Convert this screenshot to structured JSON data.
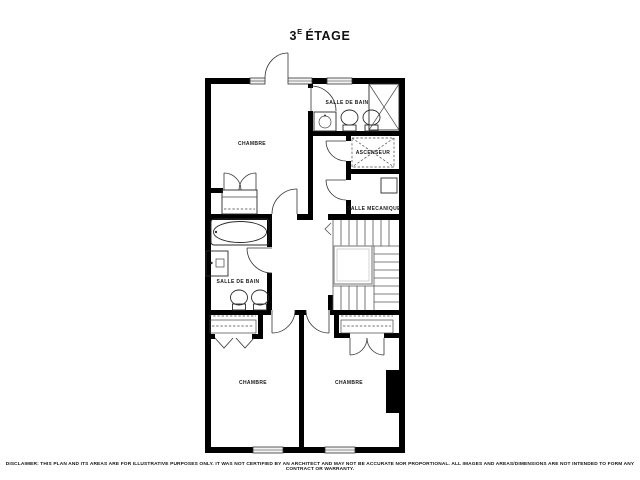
{
  "title": {
    "number": "3",
    "superscript": "E",
    "word": "ÉTAGE"
  },
  "rooms": [
    {
      "id": "chambre-top",
      "label": "CHAMBRE"
    },
    {
      "id": "salle-de-bain-top",
      "label": "SALLE DE BAIN"
    },
    {
      "id": "ascenseur",
      "label": "ASCENSEUR"
    },
    {
      "id": "salle-mecanique",
      "label": "SALLE MECANIQUE"
    },
    {
      "id": "salle-de-bain-middle",
      "label": "SALLE DE BAIN"
    },
    {
      "id": "chambre-bottom-left",
      "label": "CHAMBRE"
    },
    {
      "id": "chambre-bottom-right",
      "label": "CHAMBRE"
    }
  ],
  "disclaimer": "DISCLAIMER: THIS PLAN AND ITS AREAS ARE FOR ILLUSTRATIVE PURPOSES ONLY. IT WAS NOT CERTIFIED BY AN ARCHITECT AND MAY NOT BE ACCURATE NOR PROPORTIONAL. ALL IMAGES AND AREAS/DIMENSIONS ARE NOT INTENDED TO FORM ANY CONTRACT OR WARRANTY.",
  "colors": {
    "wall": "#000000",
    "background": "#ffffff",
    "fixture_line": "#2a2a2a",
    "stair_line": "#555555"
  }
}
